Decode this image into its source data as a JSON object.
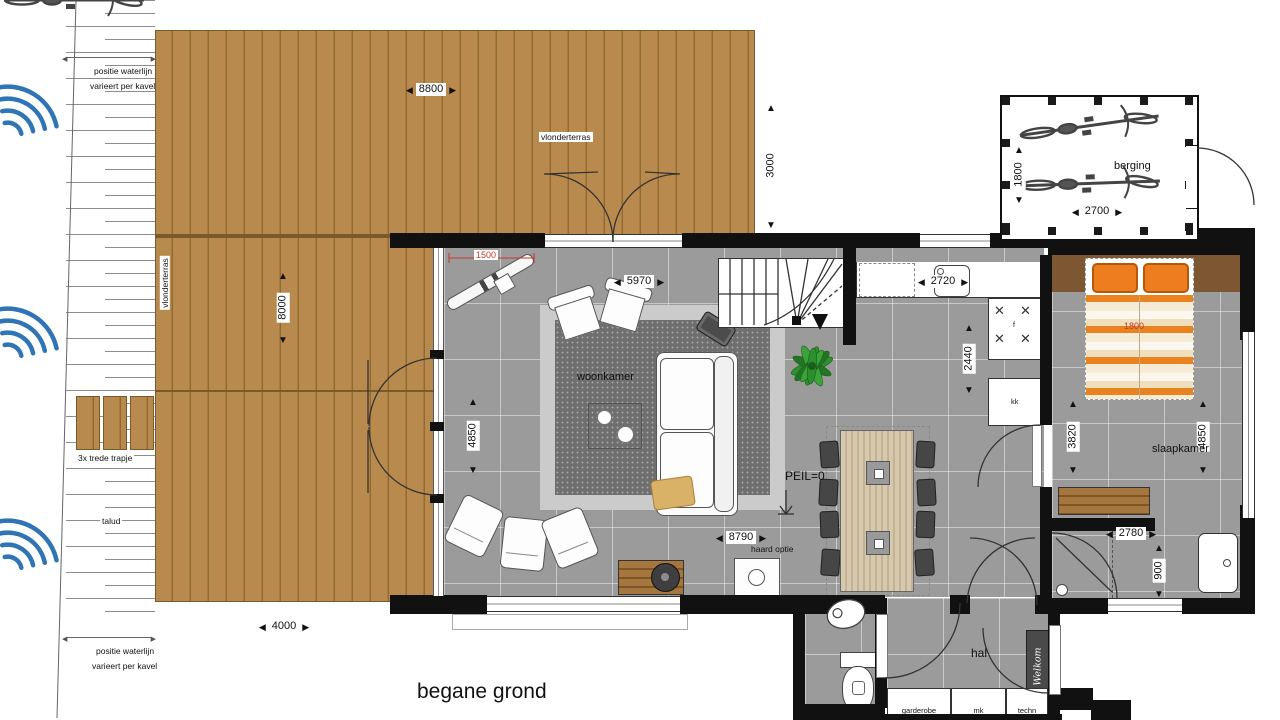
{
  "title": "begane grond",
  "site": {
    "waterline_1": "positie waterlijn",
    "waterline_2": "varieert per kavel",
    "steps": "3x trede  trapje",
    "talud": "talud"
  },
  "deck": {
    "label": "vlonderterras"
  },
  "rooms": {
    "living": "woonkamer",
    "bedroom": "slaapkamer",
    "storage": "berging",
    "hall": "hal",
    "wardrobe": "garderobe",
    "meter_closet": "mk",
    "tech": "techn"
  },
  "annotations": {
    "level": "PEIL=0",
    "fireplace": "haard optie",
    "doormat": "Welkom",
    "cooktop": "f",
    "fridge": "kk",
    "bed_width": "1800"
  },
  "dims": {
    "deck_w": "8800",
    "deck_d": "3000",
    "deck_side": "8000",
    "deck_bottom": "4000",
    "storage_d": "1800",
    "storage_w": "2700",
    "red_offset": "1500",
    "living_w": "5970",
    "kitchen_w": "2720",
    "kitchen_d": "2440",
    "living_d": "4850",
    "bedroom_a": "3820",
    "bedroom_b": "4850",
    "living_total": "8790",
    "bath_w": "2780",
    "bath_d": "900"
  }
}
